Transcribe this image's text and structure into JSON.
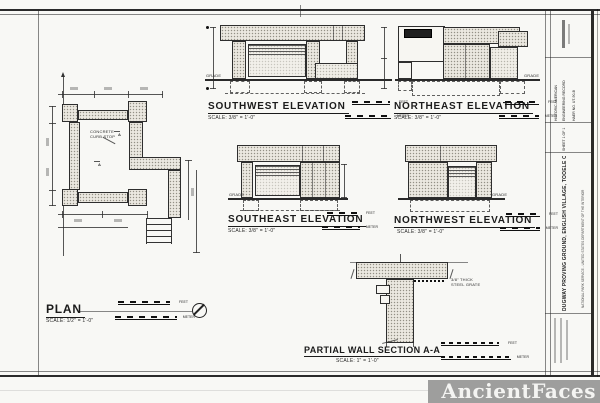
{
  "views": {
    "southwest": {
      "title": "SOUTHWEST ELEVATION",
      "scale": "SCALE: 3/8\" = 1'-0\""
    },
    "northeast": {
      "title": "NORTHEAST ELEVATION",
      "scale": "SCALE: 3/8\" = 1'-0\""
    },
    "southeast": {
      "title": "SOUTHEAST ELEVATION",
      "scale": "SCALE: 3/8\" = 1'-0\""
    },
    "northwest": {
      "title": "NORTHWEST ELEVATION",
      "scale": "SCALE: 3/8\" = 1'-0\""
    },
    "plan": {
      "title": "PLAN",
      "scale": "SCALE: 1/2\" = 1'-0\""
    },
    "section": {
      "title": "PARTIAL WALL SECTION A-A",
      "scale": "SCALE: 1\" = 1'-0\""
    }
  },
  "scalebar": {
    "feet": "FEET",
    "meter": "METER"
  },
  "annotations": {
    "grade": "GRADE",
    "concrete_note_1": "CONCRETE",
    "concrete_note_2": "CURB STOP",
    "grate_note_1": "3/8\" THICK",
    "grate_note_2": "STEEL GRATE",
    "section_marker": "A"
  },
  "titleblock": {
    "agency_line1": "HISTORIC AMERICAN",
    "agency_line2": "ENGINEERING RECORD",
    "index_label": "HAER NO. UT-90-B",
    "sheet_label": "SHEET 1 OF 1",
    "main_title": "DUGWAY PROVING GROUND, ENGLISH VILLAGE, TOOELE COUNTY, UTAH",
    "sub_title": "NATIONAL PARK SERVICE - UNITED STATES DEPARTMENT OF THE INTERIOR"
  },
  "watermark": {
    "text": "AncientFaces"
  }
}
